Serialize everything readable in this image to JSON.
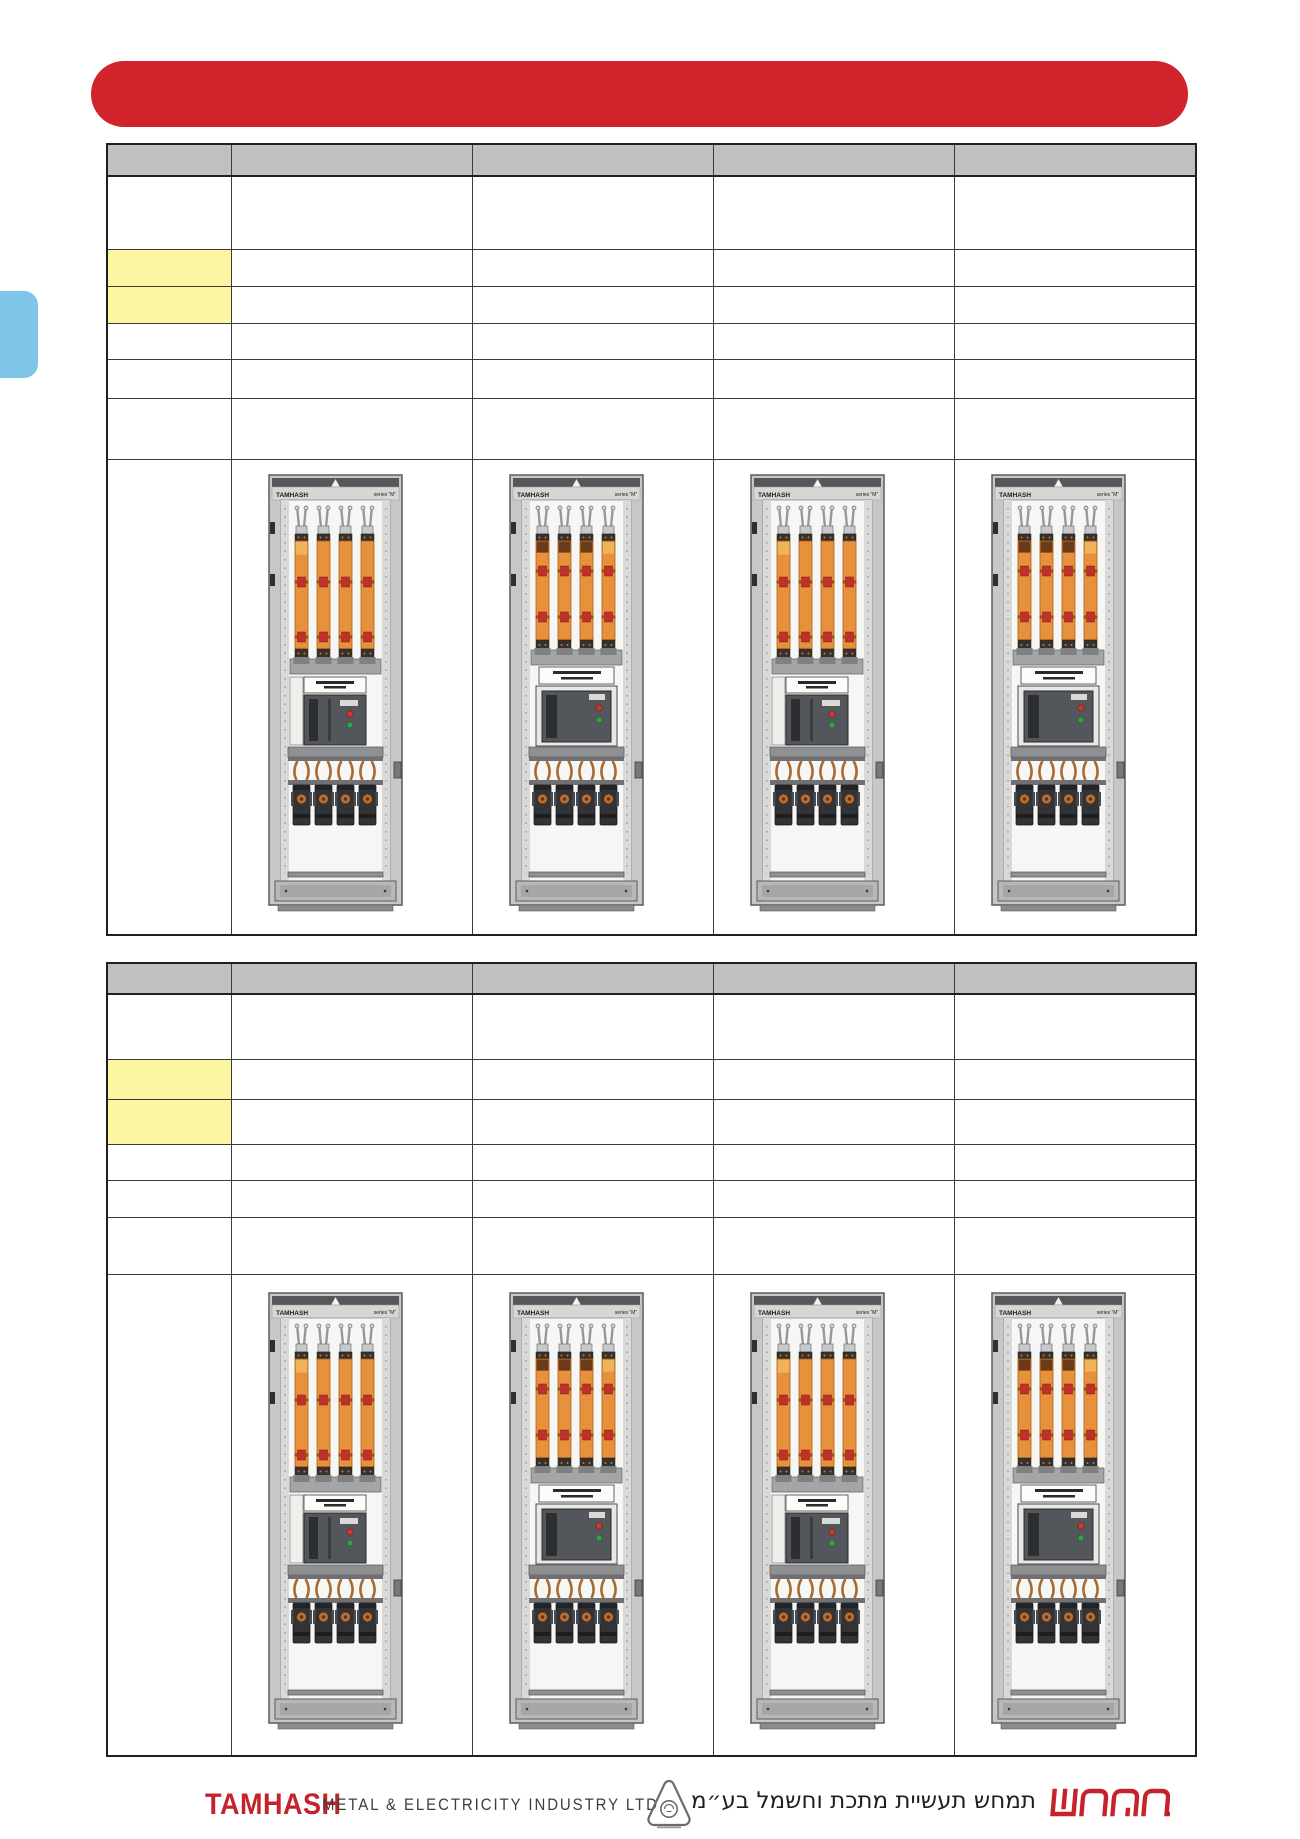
{
  "colors": {
    "banner_red": "#d0232b",
    "logo_red": "#c5232b",
    "tab_blue": "#7ec5e8",
    "header_gray": "#bec0c2",
    "highlight_yellow": "#fcf6a2"
  },
  "cabinet": {
    "brand_label": "TAMHASH",
    "series_label": "series “M”"
  },
  "footer": {
    "logo_en": "TAMHASH",
    "company_en": "METAL & ELECTRICITY INDUSTRY LTD",
    "company_he": "תמחש תעשיית מתכת וחשמל בע״מ",
    "logo_he": "תמחש"
  }
}
